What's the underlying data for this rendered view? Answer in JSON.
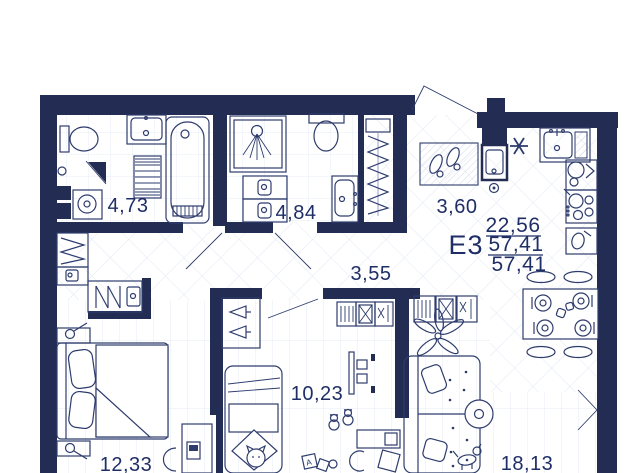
{
  "plan": {
    "unit_label": "Е3",
    "living_area": "22,56",
    "total_area": "57,41",
    "total_area_with_balcony": "57,41"
  },
  "rooms": {
    "bathroom": {
      "area": "4,73"
    },
    "shower_room": {
      "area": "4,84"
    },
    "entry_hall": {
      "area": "3,60"
    },
    "corridor": {
      "area": "3,55"
    },
    "kids_room": {
      "area": "10,23"
    },
    "bedroom": {
      "area": "12,33"
    },
    "living_room": {
      "area": "18,13"
    }
  },
  "toys": {
    "block_letter": "А"
  },
  "icons": {
    "fridge_position": "✳",
    "opening_chevron": "❯"
  },
  "colors": {
    "wall": "#232c52",
    "furniture_line": "#2e3c6d",
    "text": "#1f2e66",
    "floor_hatch": "#e2e8f3",
    "floor_plank": "#e6ecf6"
  }
}
